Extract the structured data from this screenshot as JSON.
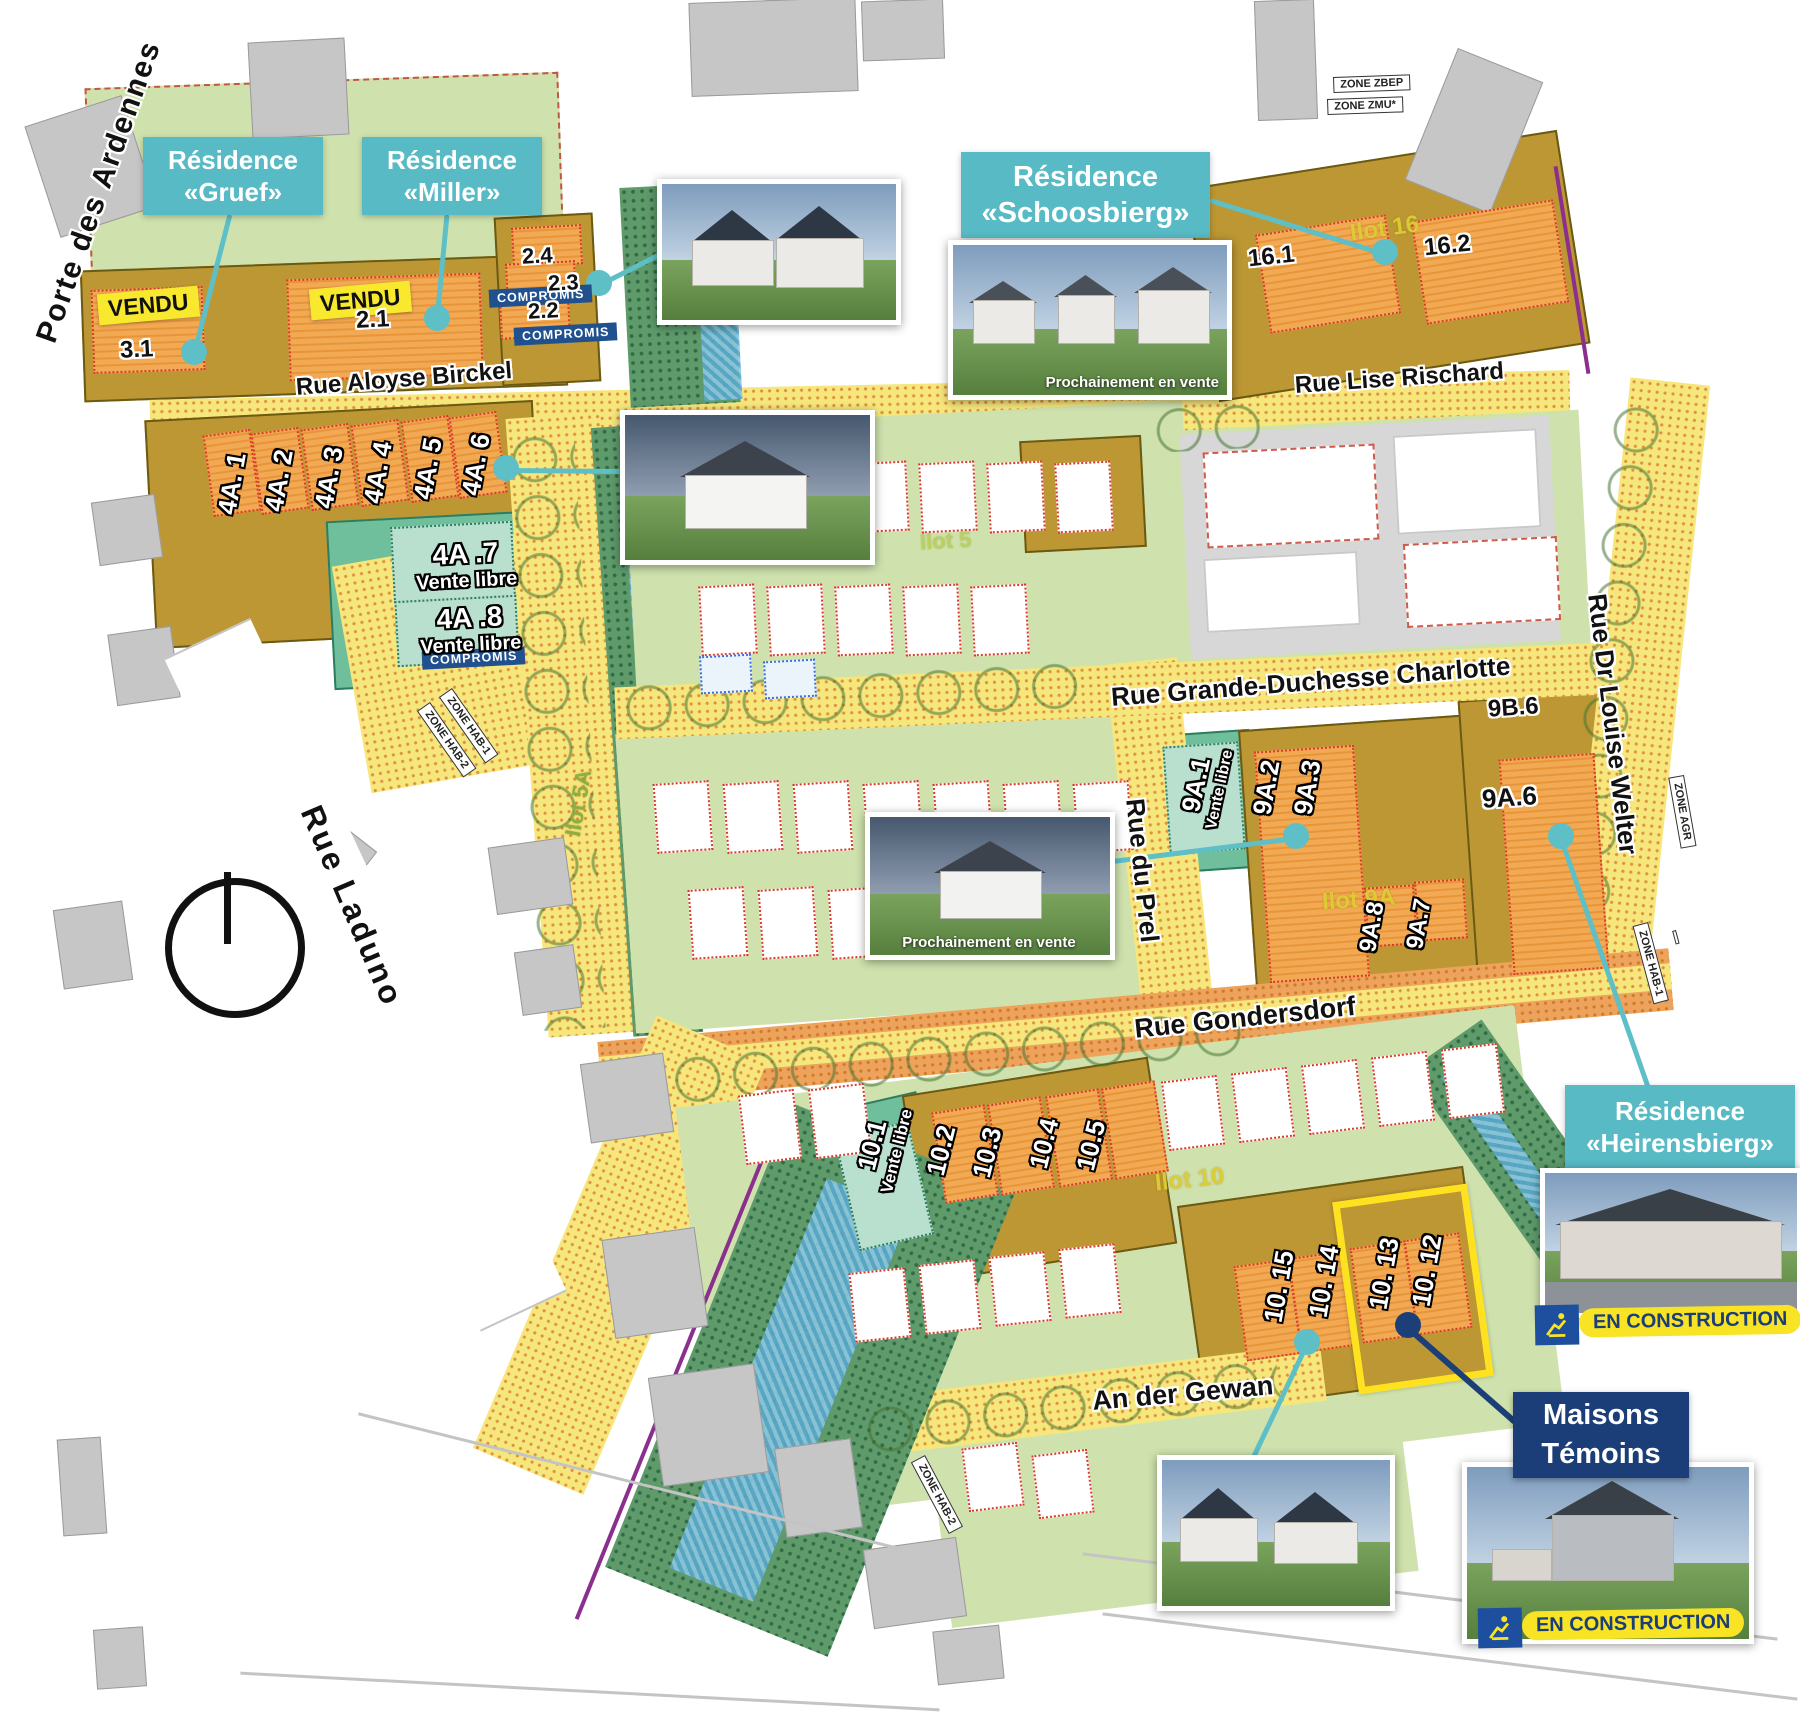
{
  "streets": {
    "porte": "Porte des Ardennes",
    "birckel": "Rue Aloyse Birckel",
    "rischard": "Rue Lise Rischard",
    "charlotte": "Rue Grande-Duchesse Charlotte",
    "prel": "Rue du Prel",
    "welter": "Rue Dr Louise Welter",
    "gondersdorf": "Rue Gondersdorf",
    "gewan": "An der Gewan",
    "laduno": "Rue Laduno"
  },
  "residences": {
    "gruef": {
      "line1": "Résidence",
      "line2": "«Gruef»"
    },
    "miller": {
      "line1": "Résidence",
      "line2": "«Miller»"
    },
    "schoosbierg": {
      "line1": "Résidence",
      "line2": "«Schoosbierg»"
    },
    "heirensbierg": {
      "line1": "Résidence",
      "line2": "«Heirensbierg»"
    }
  },
  "tags": {
    "vendu": "VENDU",
    "compromis": "COMPROMIS",
    "vente_libre": "Vente libre",
    "en_construction": "EN CONSTRUCTION",
    "prochainement": "Prochainement en vente",
    "maisons_line1": "Maisons",
    "maisons_line2": "Témoins"
  },
  "lots": {
    "p31": "3.1",
    "p21": "2.1",
    "p24": "2.4",
    "p23": "2.3",
    "p22": "2.2",
    "p161": "16.1",
    "p162": "16.2",
    "p4a1": "4A. 1",
    "p4a2": "4A. 2",
    "p4a3": "4A. 3",
    "p4a4": "4A. 4",
    "p4a5": "4A. 5",
    "p4a6": "4A. 6",
    "p4a7": "4A .7",
    "p4a8": "4A .8",
    "p9a1": "9A.1",
    "p9a2": "9A.2",
    "p9a3": "9A.3",
    "p9b6": "9B.6",
    "p9a6": "9A.6",
    "p9a8": "9A.8",
    "p9a7": "9A.7",
    "p101": "10.1",
    "p102": "10.2",
    "p103": "10.3",
    "p104": "10.4",
    "p105": "10.5",
    "p1015": "10. 15",
    "p1014": "10. 14",
    "p1013": "10. 13",
    "p1012": "10. 12"
  },
  "ilots": {
    "i16": "Ilot 16",
    "i9a": "Ilot 9A",
    "i10": "Ilot 10",
    "i5a": "Ilot 5A",
    "i5": "Ilot 5"
  },
  "zones": {
    "zbep": "ZONE ZBEP",
    "zmu": "ZONE ZMU*",
    "hab1": "ZONE HAB-1",
    "hab2": "ZONE HAB-2",
    "agr": "ZONE AGR"
  },
  "colors": {
    "teal_label": "#57bac4",
    "vendu_yellow": "#f8e92f",
    "compromis_navy": "#20508e",
    "construction_navy": "#1c3e78",
    "construction_yellow": "#f8e324",
    "highlight_yellow": "#ffe21f"
  }
}
